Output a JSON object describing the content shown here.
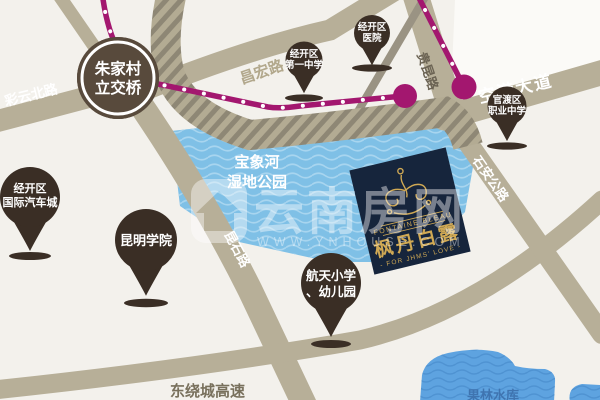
{
  "watermark": {
    "brand": "云南房网",
    "url": "WWW.YNHOUSE.COM"
  },
  "interchange": {
    "lines": [
      "朱家村",
      "立交桥"
    ]
  },
  "roads": {
    "caiyun": {
      "label": "彩云北路"
    },
    "changhong": {
      "label": "昌宏路"
    },
    "guikun": {
      "label": "贵昆路"
    },
    "konggang": {
      "label": "空港大道"
    },
    "shian": {
      "label": "石安公路"
    },
    "kunshi": {
      "label": "昆石路"
    },
    "expressway": {
      "label": "东绕城高速"
    }
  },
  "pois": {
    "auto_city": {
      "lines": [
        "经开区",
        "国际汽车城"
      ]
    },
    "kunming_college": {
      "lines": [
        "昆明学院"
      ]
    },
    "no1_school": {
      "lines": [
        "经开区",
        "第一中学"
      ]
    },
    "hospital": {
      "lines": [
        "经开区",
        "医院"
      ]
    },
    "vocational": {
      "lines": [
        "官渡区",
        "职业中学"
      ]
    },
    "hangtian": {
      "lines": [
        "航天小学",
        "、幼儿园"
      ]
    }
  },
  "waters": {
    "wetland": {
      "lines": [
        "宝象河",
        "湿地公园"
      ]
    },
    "reservoir": {
      "label": "果林水库"
    }
  },
  "project": {
    "name_en": "FONTAINE BLEAU",
    "name_zh": "枫丹白露",
    "tagline": "- FOR JHMS' LOVE -"
  },
  "colors": {
    "metro": "#a3176f",
    "road": "#b7af98",
    "pin": "#3a2e25",
    "wetland": "#7fc0e6",
    "reservoir": "#5ea3e0",
    "navy": "#16253c",
    "gold": "#d0a954"
  }
}
